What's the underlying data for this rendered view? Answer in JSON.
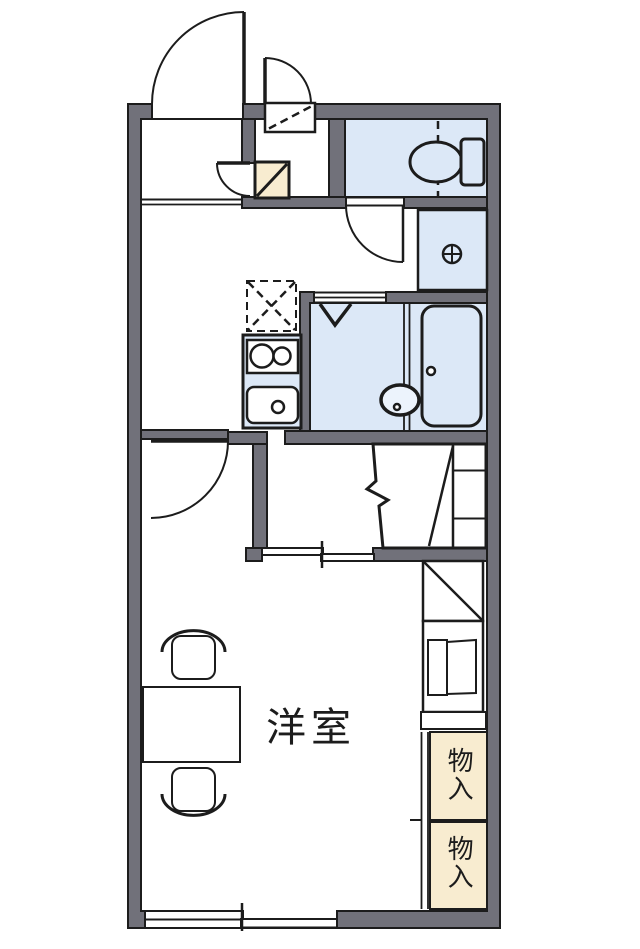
{
  "plan": {
    "kind": "apartment floor plan",
    "labels": {
      "main_room": "洋室",
      "storage_upper": "物入",
      "storage_lower": "物入"
    },
    "symbols": {
      "washer_drain_icon": "circle-cross drain",
      "shower_icon": "V mark",
      "refrigerator_space_icon": "dashed X box",
      "entrance_step_icon": "diagonal square"
    },
    "colors": {
      "wall": "#71717a",
      "line": "#1c1c1c",
      "fixture": "#dce8f7",
      "storage": "#f8ecd0",
      "bg": "#ffffff"
    }
  }
}
